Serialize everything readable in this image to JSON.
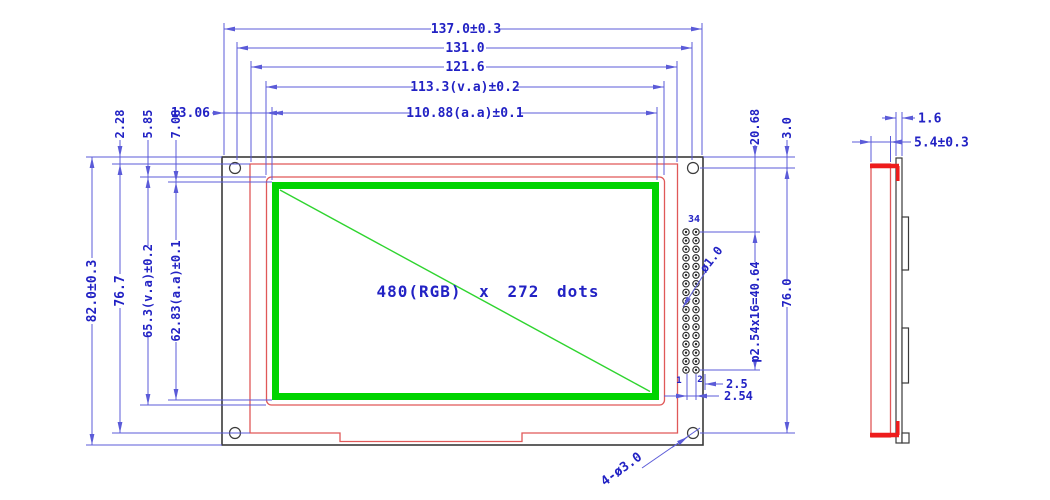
{
  "colors": {
    "dim_line": "#5b5bd8",
    "dim_text": "#2222c4",
    "frame_red": "#e05858",
    "panel_red": "#ee1c1c",
    "active_green": "#00d400",
    "diag_green": "#2fd42f",
    "outline_black": "#3a3a3a"
  },
  "front_view": {
    "display_area_label": "480(RGB) x 272 dots",
    "top_dims": {
      "overall_width": "137.0±0.3",
      "hole_span_width": "131.0",
      "frame_width": "121.6",
      "view_area_width": "113.3(v.a)±0.2",
      "active_area_width": "110.88(a.a)±0.1"
    },
    "left_dims": {
      "overall_height": "82.0±0.3",
      "frame_height": "76.7",
      "view_area_height": "65.3(v.a)±0.2",
      "active_area_height": "62.83(a.a)±0.1"
    },
    "offset_dims": {
      "frame_top": "2.28",
      "view_area_top": "5.85",
      "active_area_top": "7.08",
      "active_area_left": "13.06"
    },
    "right_dims": {
      "pin_row_offset": "20.68",
      "hole_top_offset": "3.0",
      "hole_span_height": "76.0",
      "pin_pitch": "p2.54x16=40.64",
      "pin_edge_gap": "2.5",
      "pin_col_pitch": "2.54"
    },
    "callouts": {
      "pin_hole_dia": "ø1.0",
      "mounting_holes": "4-ø3.0"
    },
    "connector": {
      "count_label": "34",
      "pin1_label": "1",
      "pin2_label": "2",
      "cols": 2,
      "rows": 17
    }
  },
  "side_view": {
    "dims": {
      "pcb_thickness": "1.6",
      "total_thickness": "5.4±0.3"
    }
  }
}
